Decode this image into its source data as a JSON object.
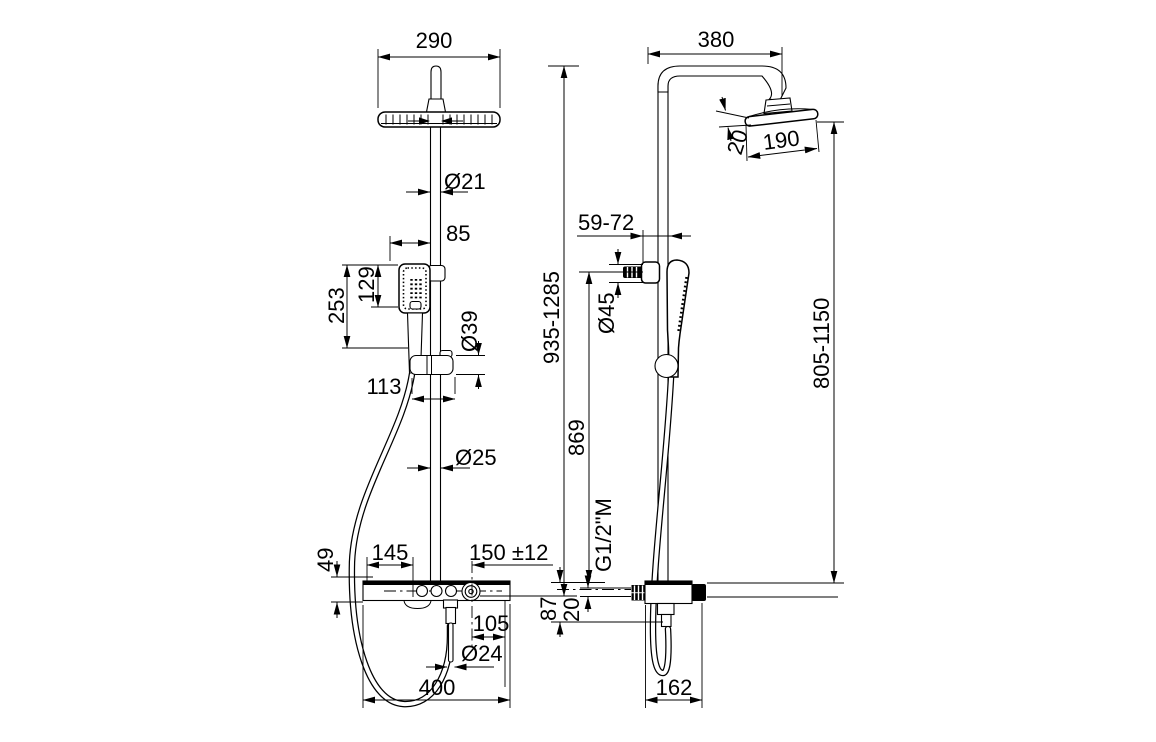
{
  "drawing": {
    "type": "technical-dimension-drawing",
    "subject": "shower column with overhead shower, hand shower and shelf mixer — front and side views, dimensions in mm",
    "front_view": {
      "head_width": "290",
      "riser_upper_diameter": "Ø21",
      "handshower_to_riser": "85",
      "handshower_head_height": "129",
      "handshower_total_height": "253",
      "holder_diameter": "Ø39",
      "handshower_offset": "113",
      "riser_lower_diameter": "Ø25",
      "shelf_thickness": "49",
      "shelf_edge_to_outlet": "145",
      "inlet_spacing": "150 ±12",
      "knob_to_edge": "105",
      "hose_connector_diameter": "Ø24",
      "shelf_width": "400",
      "total_height_range": "935-1285"
    },
    "side_view": {
      "top_projection": "380",
      "head_thickness": "20",
      "head_length": "190",
      "bracket_projection": "59-72",
      "bracket_diameter": "Ø45",
      "bracket_to_shelf": "869",
      "head_to_shelf_range": "805-1150",
      "supply_thread": "G1/2\"M",
      "mixer_drop": "87",
      "supply_offset": "20",
      "mixer_depth": "162"
    }
  }
}
